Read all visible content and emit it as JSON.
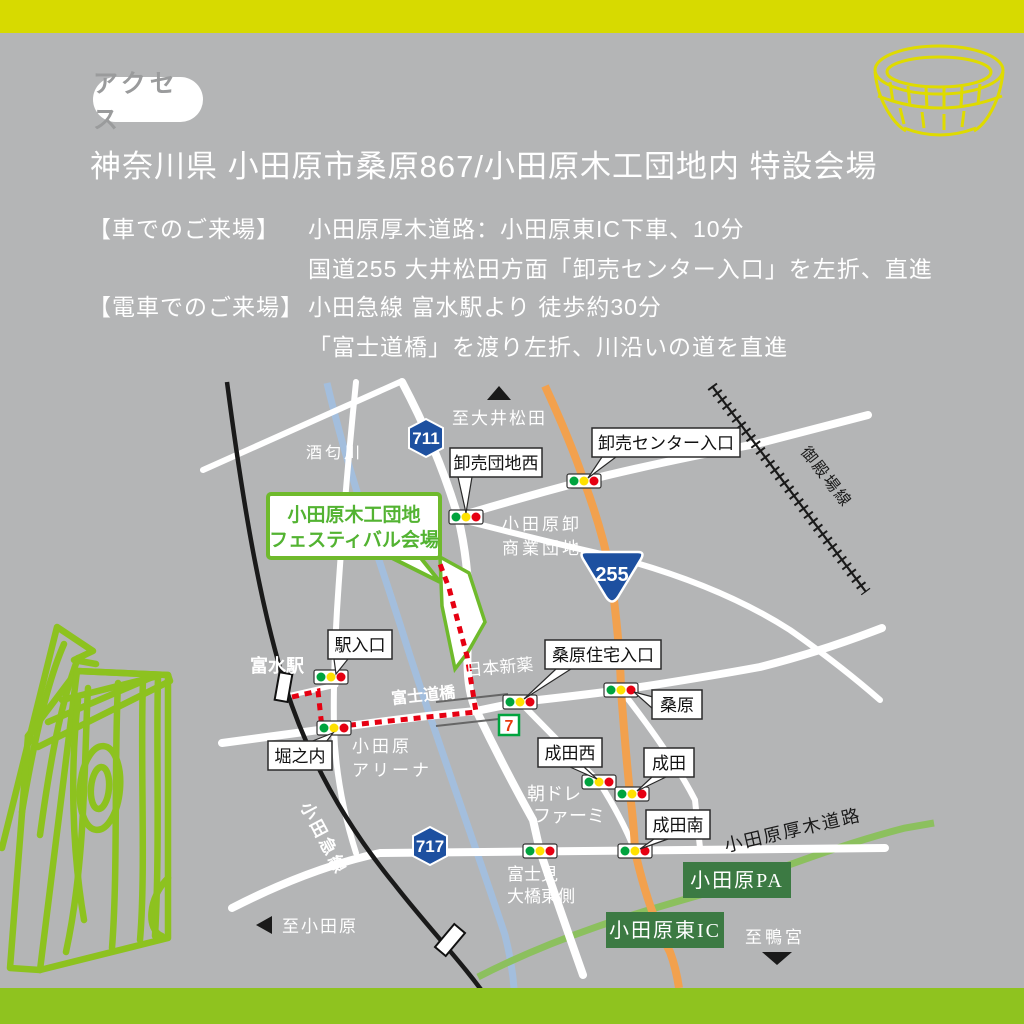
{
  "colors": {
    "background": "#b4b5b6",
    "top_bar": "#d7da00",
    "bottom_bar": "#8fc31f",
    "accent_green": "#6fba2c",
    "dark_green_box": "#3c7a43",
    "road_orange": "#f2a14e",
    "road_green": "#8cc05e",
    "river_blue": "#a3bedd",
    "signal_green": "#00a33e",
    "signal_yellow": "#ffe100",
    "signal_red": "#e60012",
    "route_red": "#e60012",
    "shield_blue": "#1d50a0"
  },
  "header": {
    "badge": "アクセス",
    "address": "神奈川県 小田原市桑原867/小田原木工団地内 特設会場",
    "car_label": "【車でのご来場】",
    "car_line1": "小田原厚木道路：小田原東IC下車、10分",
    "car_line2": "国道255 大井松田方面「卸売センター入口」を左折、直進",
    "train_label": "【電車でのご来場】",
    "train_line1": "小田急線 富水駅より 徒歩約30分",
    "train_line2": "「富士道橋」を渡り左折、川沿いの道を直進"
  },
  "map": {
    "venue": {
      "line1": "小田原木工団地",
      "line2": "フェスティバル会場"
    },
    "shields": {
      "s711": "711",
      "s717": "717",
      "s255": "255"
    },
    "signals": {
      "oroshidanchi_nishi": "卸売団地西",
      "oroshiuri_center": "卸売センター入口",
      "eki_iriguchi": "駅入口",
      "horinouchi": "堀之内",
      "kuwahara_jutaku": "桑原住宅入口",
      "kuwahara": "桑原",
      "narita_nishi": "成田西",
      "narita": "成田",
      "narita_minami": "成田南"
    },
    "places": {
      "sakawa_river": "酒匂川",
      "gotemba_line": "御殿場線",
      "odakyu_line": "小田急線",
      "tomizu_station": "富水駅",
      "fujimichi_bridge": "富士道橋",
      "nihon_shinyaku": "日本新薬",
      "oroshi_dist1": "小田原卸",
      "oroshi_dist2": "商業団地",
      "arena1": "小田原",
      "arena2": "アリーナ",
      "asadore1": "朝ドレ",
      "asadore2": "ファーミ",
      "fujimi1": "富士見",
      "fujimi2": "大橋東側",
      "atsugi_road": "小田原厚木道路",
      "odawara_pa": "小田原PA",
      "odawara_higashi_ic": "小田原東IC",
      "seven": "7"
    },
    "direction_markers": {
      "to_oimatsuda": "至大井松田",
      "to_odawara": "至小田原",
      "to_kamonomiya": "至鴨宮"
    }
  }
}
